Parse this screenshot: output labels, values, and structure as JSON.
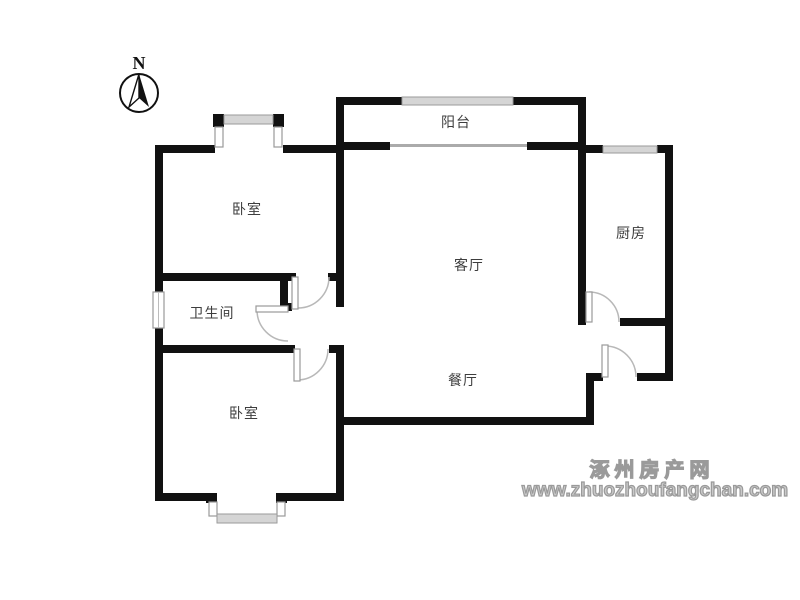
{
  "compass": {
    "label": "N"
  },
  "rooms": {
    "balcony": {
      "label": "阳台"
    },
    "bedroom_top": {
      "label": "卧室"
    },
    "kitchen": {
      "label": "厨房"
    },
    "living_room": {
      "label": "客厅"
    },
    "bathroom": {
      "label": "卫生间"
    },
    "dining_room": {
      "label": "餐厅"
    },
    "bedroom_bottom": {
      "label": "卧室"
    }
  },
  "watermark": {
    "site_name": "涿州房产网",
    "site_url": "www.zhuozhoufangchan.com"
  },
  "colors": {
    "wall": "#111111",
    "window_band": "#d5d5d5",
    "window_edge": "#9a9a9a",
    "door_arc": "#b8b8b8",
    "room_label": "#3d3d3d",
    "watermark": "#9a9a9a",
    "background": "#ffffff"
  }
}
